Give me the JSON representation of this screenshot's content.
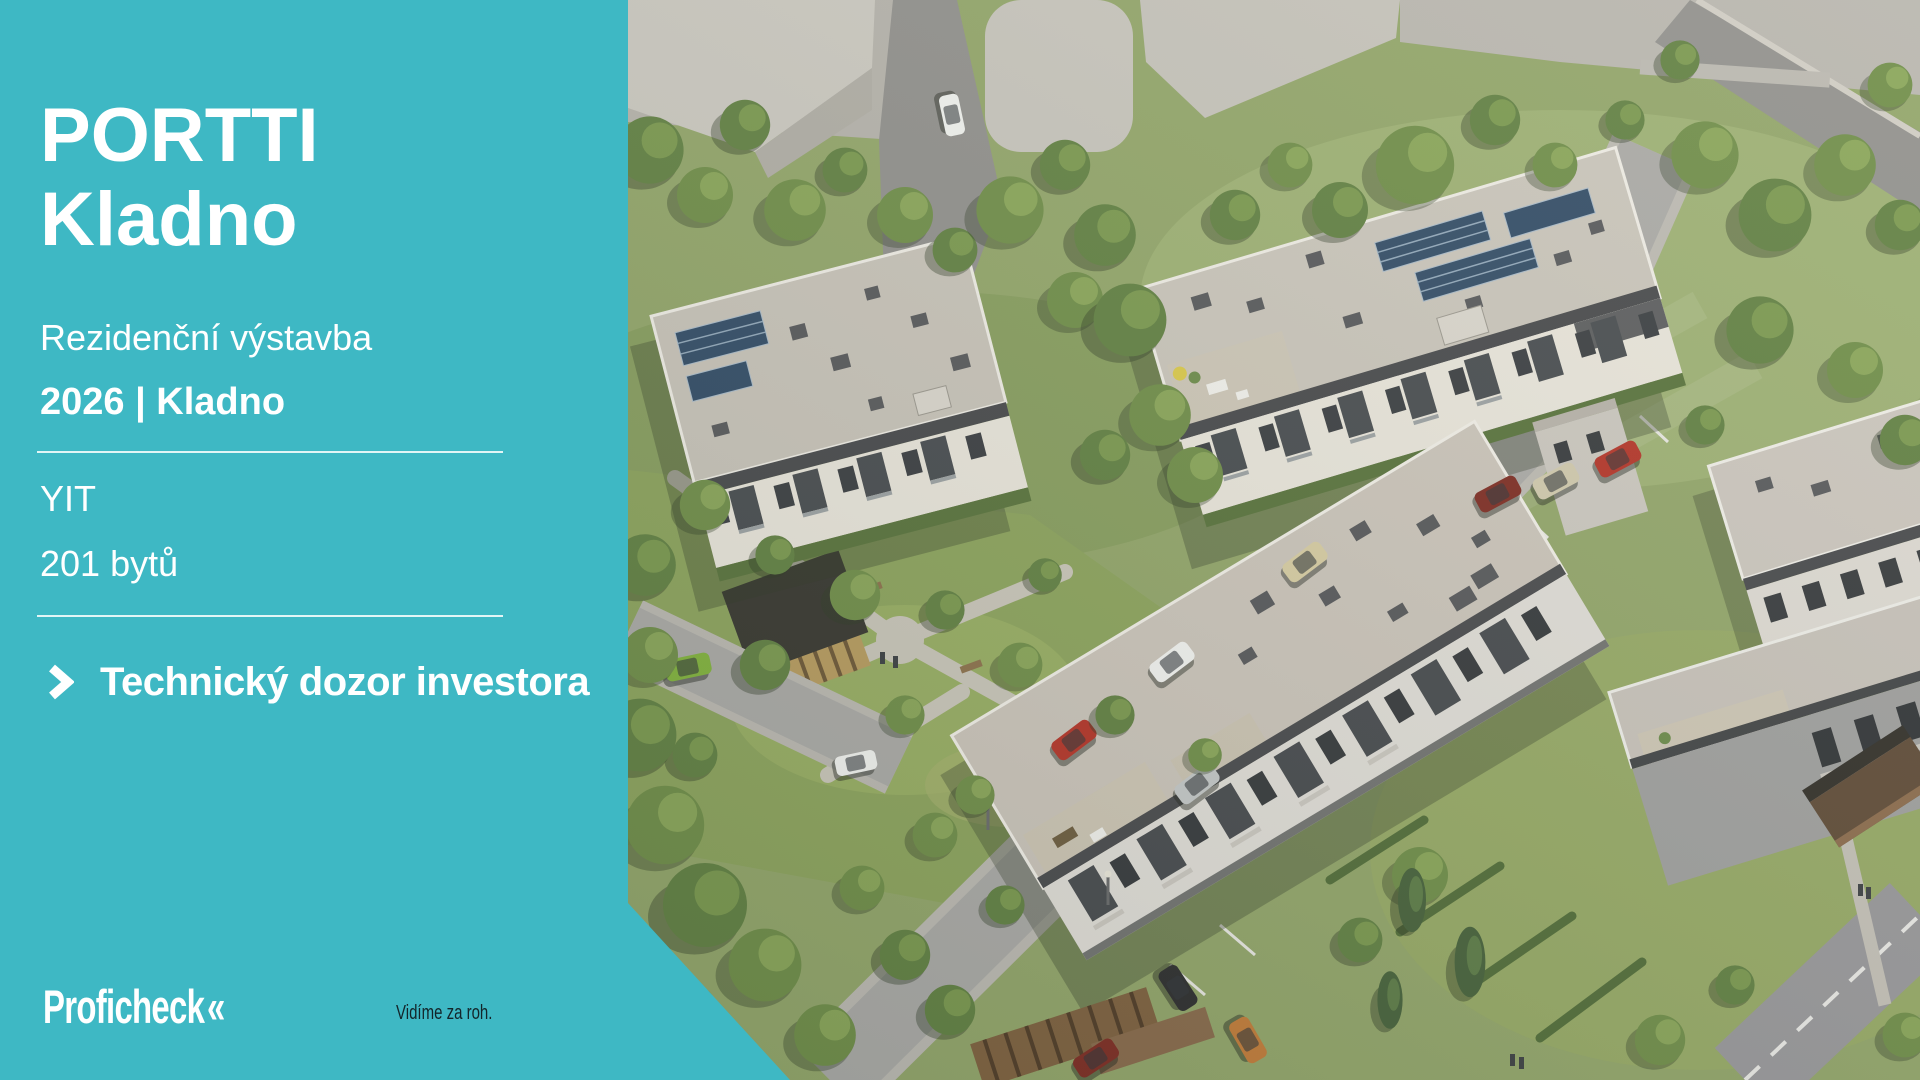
{
  "slide": {
    "accent_color": "#3EB8C4",
    "title": {
      "line1": "PORTTI",
      "line2": "Kladno"
    },
    "subtitle": "Rezidenční výstavba",
    "meta": "2026 | Kladno",
    "details": {
      "developer": "YIT",
      "units": "201 bytů"
    },
    "service": {
      "label": "Technický dozor investora",
      "icon": "chevron-right-icon"
    },
    "footer": {
      "logo_text": "Proficheck",
      "logo_mark": "«",
      "tagline": "Vidíme za roh."
    },
    "image_alt": "Aerial 3D visualization of the PORTTI Kladno residential development: white flat-roofed apartment buildings with solar panels and balconies, streets with parked cars and a green courtyard park"
  }
}
